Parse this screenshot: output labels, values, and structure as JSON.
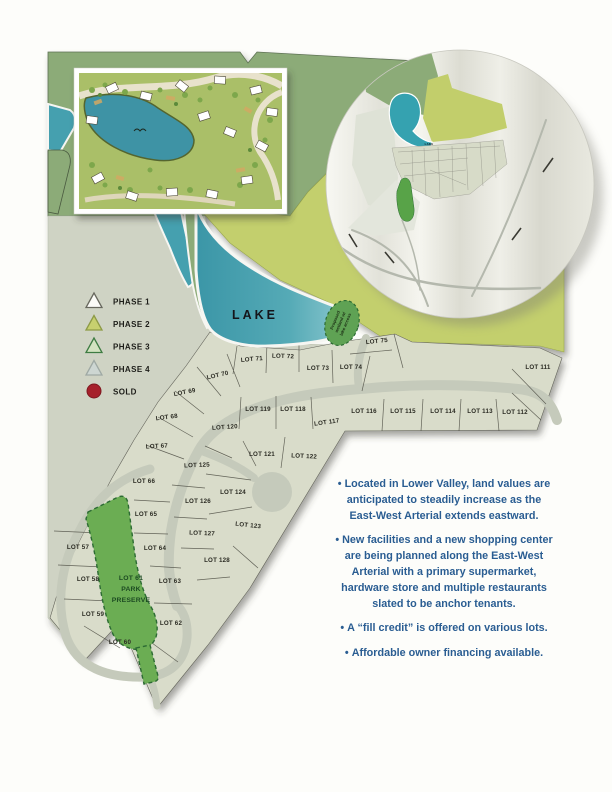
{
  "map": {
    "lake_label": "LAKE",
    "colors": {
      "lake_teal": "#3d9aaa",
      "sage_green": "#8cab78",
      "yellow_green": "#c3cf6d",
      "land_gray": "#cfd3c4",
      "park_green": "#6bad53",
      "sold_red": "#a6202b",
      "notes_blue": "#2a5d92"
    },
    "legend": {
      "items": [
        {
          "label": "PHASE 1",
          "shape": "triangle",
          "fill": "#fbfbf7",
          "stroke": "#68685e"
        },
        {
          "label": "PHASE 2",
          "shape": "triangle",
          "fill": "#c7d06f",
          "stroke": "#8d9a46"
        },
        {
          "label": "PHASE 3",
          "shape": "triangle",
          "fill": "#d3e3c1",
          "stroke": "#3e7c42"
        },
        {
          "label": "PHASE 4",
          "shape": "triangle",
          "fill": "#cdd6d2",
          "stroke": "#9fa9a4"
        },
        {
          "label": "SOLD",
          "shape": "circle",
          "fill": "#a6202b",
          "stroke": "#7e1820"
        }
      ]
    },
    "lots": [
      {
        "label": "LOT 57",
        "x": 78,
        "y": 549,
        "r": 0
      },
      {
        "label": "LOT 58",
        "x": 88,
        "y": 581,
        "r": 0
      },
      {
        "label": "LOT 59",
        "x": 93,
        "y": 616,
        "r": 0
      },
      {
        "label": "LOT 60",
        "x": 120,
        "y": 644,
        "r": 0
      },
      {
        "label": "LOT 62",
        "x": 171,
        "y": 625,
        "r": 0
      },
      {
        "label": "LOT 63",
        "x": 170,
        "y": 583,
        "r": 0
      },
      {
        "label": "LOT 64",
        "x": 155,
        "y": 550,
        "r": 0
      },
      {
        "label": "LOT 65",
        "x": 146,
        "y": 516,
        "r": 0
      },
      {
        "label": "LOT 66",
        "x": 144,
        "y": 483,
        "r": 0
      },
      {
        "label": "LOT 67",
        "x": 157,
        "y": 448,
        "r": -3
      },
      {
        "label": "LOT 68",
        "x": 167,
        "y": 419,
        "r": -7
      },
      {
        "label": "LOT 69",
        "x": 185,
        "y": 394,
        "r": -11
      },
      {
        "label": "LOT 70",
        "x": 218,
        "y": 377,
        "r": -13
      },
      {
        "label": "LOT 71",
        "x": 252,
        "y": 361,
        "r": -5
      },
      {
        "label": "LOT 72",
        "x": 283,
        "y": 358,
        "r": 2
      },
      {
        "label": "LOT 73",
        "x": 318,
        "y": 370,
        "r": 0
      },
      {
        "label": "LOT 74",
        "x": 351,
        "y": 369,
        "r": 0
      },
      {
        "label": "LOT 75",
        "x": 377,
        "y": 343,
        "r": -6
      },
      {
        "label": "LOT 111",
        "x": 538,
        "y": 369,
        "r": 0
      },
      {
        "label": "LOT 112",
        "x": 515,
        "y": 414,
        "r": 0
      },
      {
        "label": "LOT 113",
        "x": 480,
        "y": 413,
        "r": 0
      },
      {
        "label": "LOT 114",
        "x": 443,
        "y": 413,
        "r": 0
      },
      {
        "label": "LOT 115",
        "x": 403,
        "y": 413,
        "r": 0
      },
      {
        "label": "LOT 116",
        "x": 364,
        "y": 413,
        "r": 0
      },
      {
        "label": "LOT 117",
        "x": 327,
        "y": 424,
        "r": -8
      },
      {
        "label": "LOT 118",
        "x": 293,
        "y": 411,
        "r": 0
      },
      {
        "label": "LOT 119",
        "x": 258,
        "y": 411,
        "r": 0
      },
      {
        "label": "LOT 120",
        "x": 225,
        "y": 429,
        "r": -4
      },
      {
        "label": "LOT 121",
        "x": 262,
        "y": 456,
        "r": 0
      },
      {
        "label": "LOT 122",
        "x": 304,
        "y": 458,
        "r": 3
      },
      {
        "label": "LOT 123",
        "x": 248,
        "y": 527,
        "r": 6
      },
      {
        "label": "LOT 124",
        "x": 233,
        "y": 494,
        "r": 0
      },
      {
        "label": "LOT 125",
        "x": 197,
        "y": 467,
        "r": -2
      },
      {
        "label": "LOT 126",
        "x": 198,
        "y": 503,
        "r": 0
      },
      {
        "label": "LOT 127",
        "x": 202,
        "y": 535,
        "r": 2
      },
      {
        "label": "LOT 128",
        "x": 217,
        "y": 562,
        "r": 0
      }
    ],
    "park": {
      "x": 131,
      "y": 580,
      "step": 11,
      "lines": [
        "LOT 61",
        "PARK",
        "PRESERVE"
      ]
    },
    "wetland": {
      "lines": [
        "Proposed",
        "wetland w/",
        "lake access"
      ]
    },
    "inset_circle": {
      "lake_label": "LAKE"
    }
  },
  "notes": {
    "marker": "•",
    "color": "#2a5d92",
    "items": [
      {
        "lines": [
          "Located in Lower Valley, land values are",
          "anticipated to steadily increase as the",
          "East-West Arterial extends eastward."
        ]
      },
      {
        "lines": [
          "New facilities and a new shopping center",
          "are being planned along the East-West",
          "Arterial with a primary supermarket,",
          "hardware store and multiple restaurants",
          "slated to be anchor tenants."
        ]
      },
      {
        "lines": [
          "A “fill credit” is offered on various lots."
        ]
      },
      {
        "lines": [
          "Affordable owner financing available."
        ]
      }
    ]
  }
}
